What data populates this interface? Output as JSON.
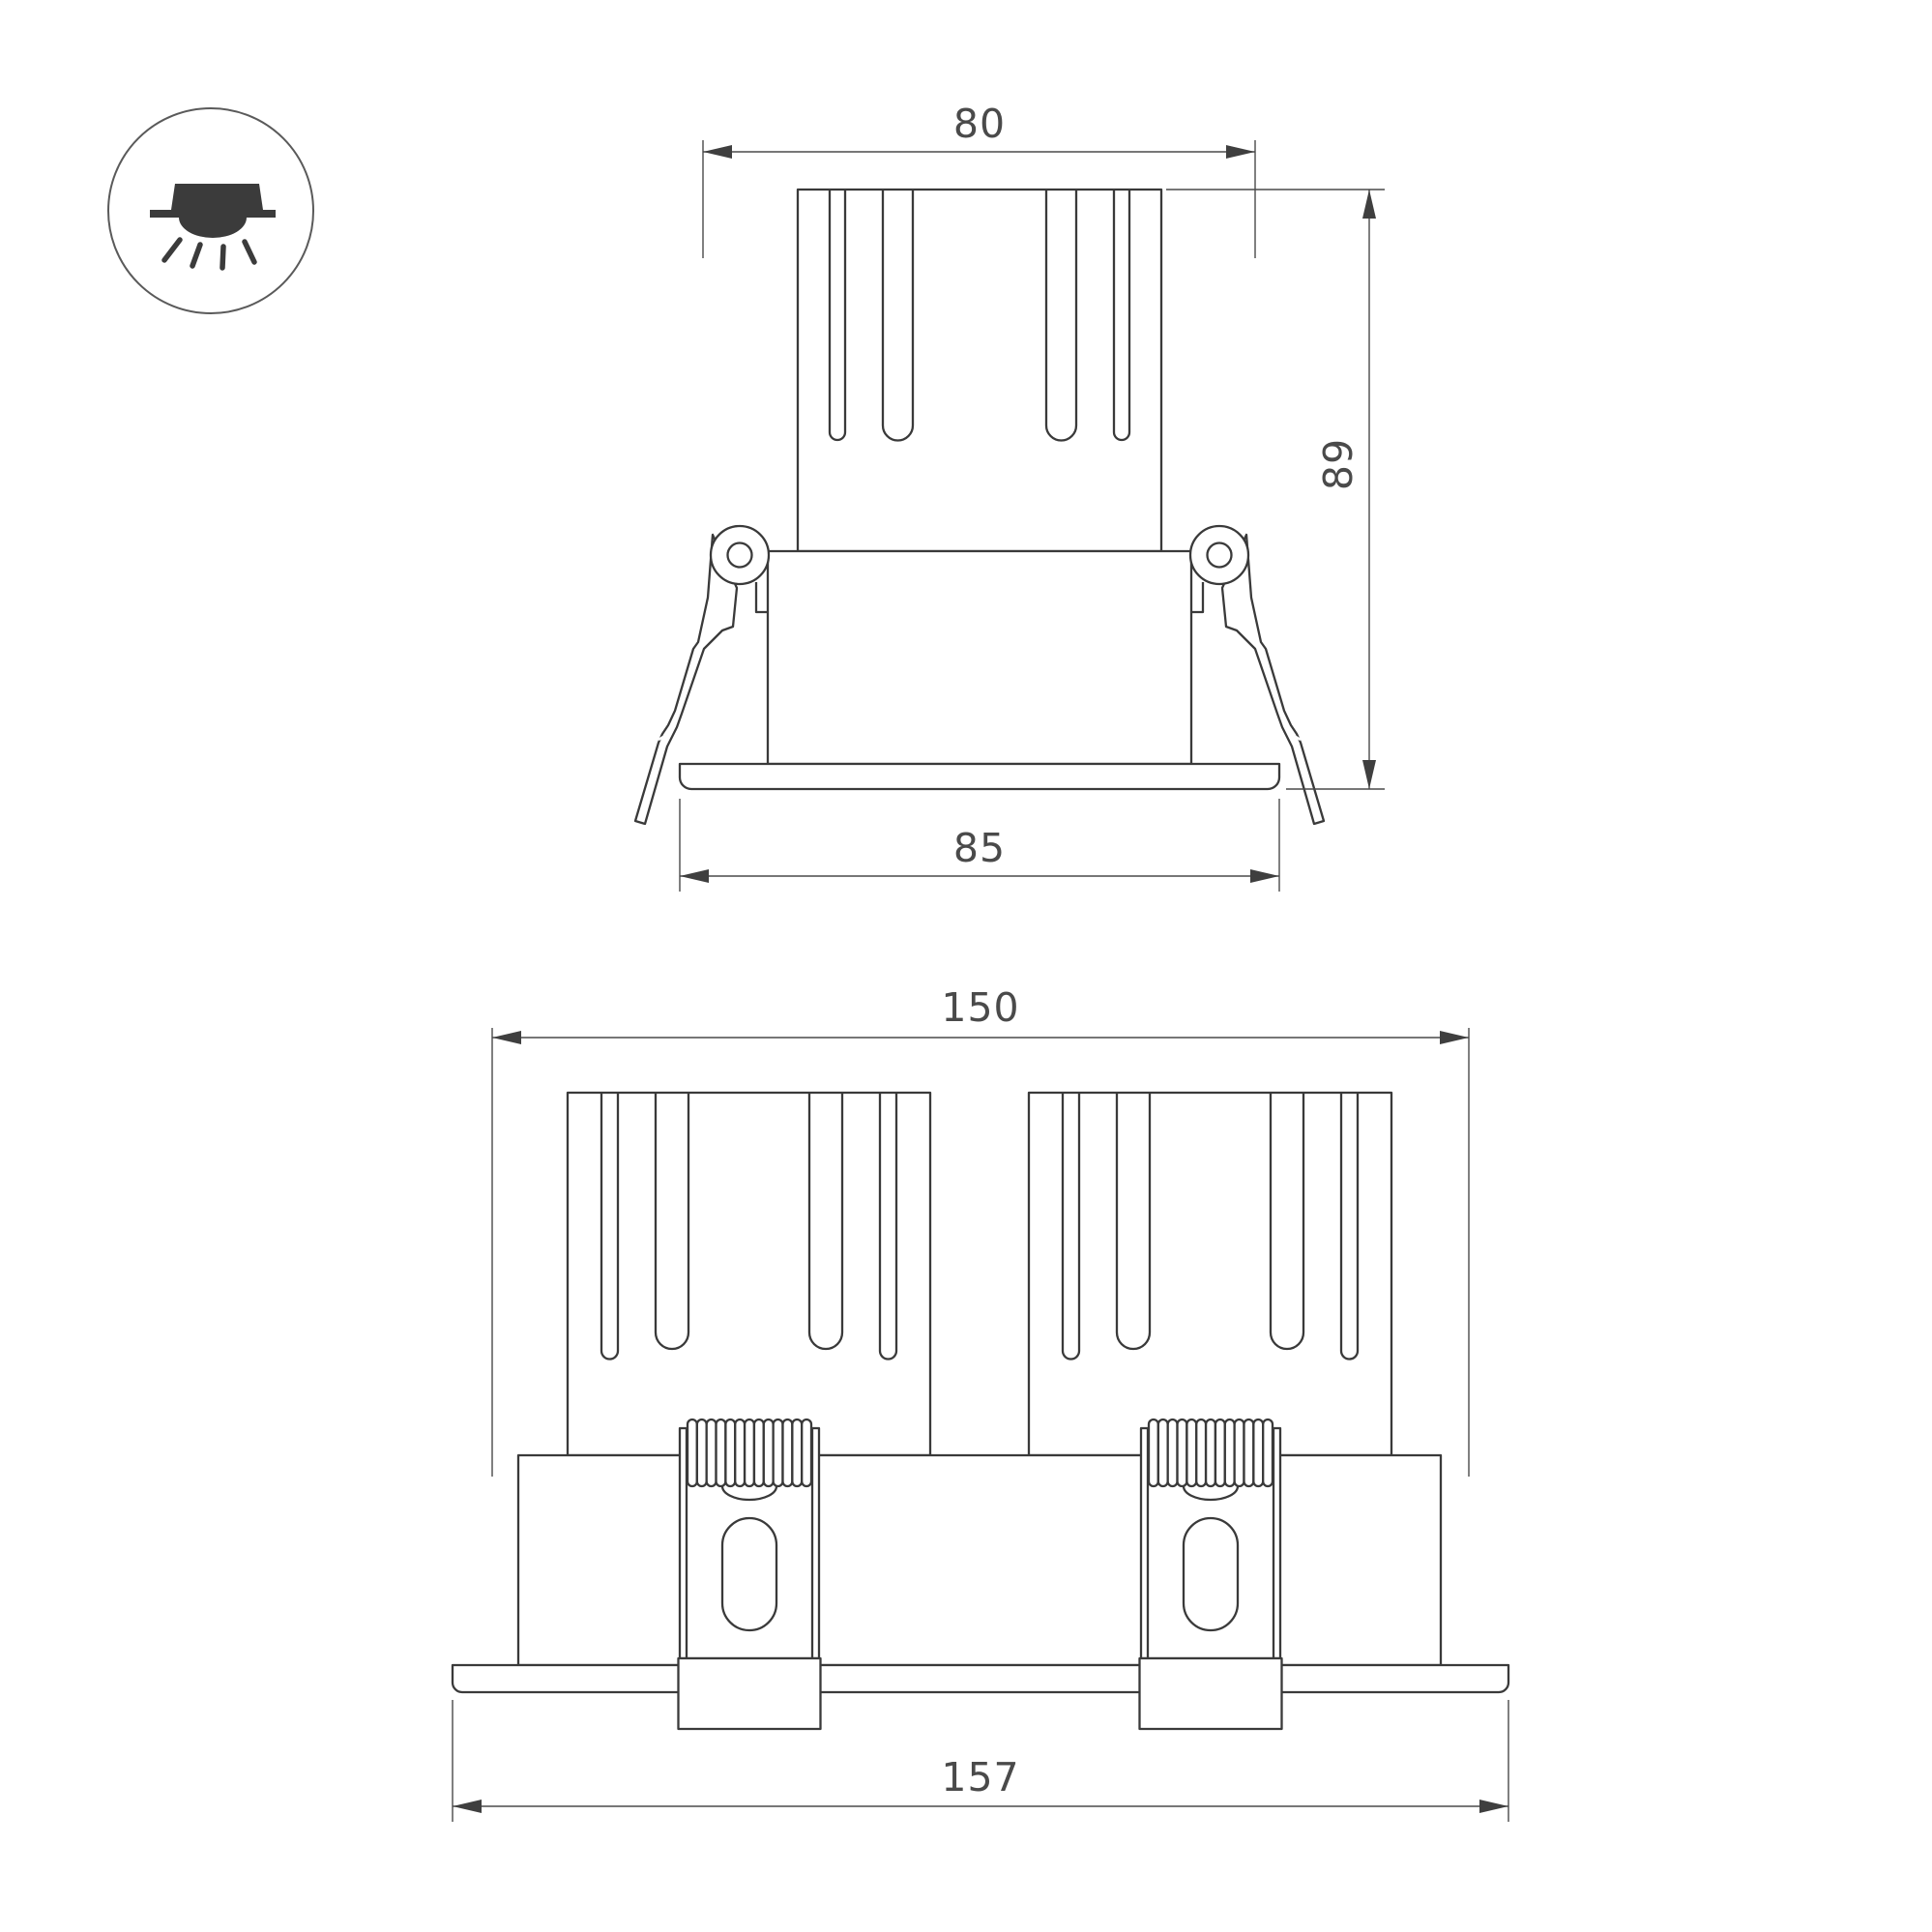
{
  "drawing": {
    "type": "technical-dimension-drawing",
    "subject": "recessed LED downlight luminaire",
    "background_color": "#ffffff",
    "part_line_color": "#3a3a3a",
    "dimension_line_color": "#4a4a4a",
    "icon": {
      "name": "recessed-downlight-icon",
      "description": "circled pictogram of a recessed ceiling light shining downward"
    },
    "views": {
      "single": {
        "name": "single module front elevation",
        "dims": {
          "top_width": "80",
          "total_height": "89",
          "flange_width": "85"
        }
      },
      "double": {
        "name": "dual module front elevation",
        "dims": {
          "body_width": "150",
          "flange_width": "157"
        }
      }
    }
  }
}
